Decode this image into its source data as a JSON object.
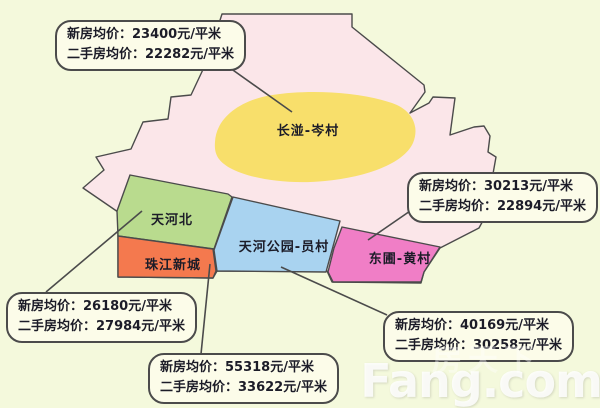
{
  "theme": {
    "bg": "#F4F9DC",
    "map_base": "#FBE6E9",
    "outline": "#4B4B4B",
    "bubble_fill": "#FCFCE9",
    "bubble_border": "#4B4B4B",
    "text_dark": "#1C1C28"
  },
  "map": {
    "outline_color": "#4B4B4B",
    "base_color": "#FBE6E9",
    "regions": [
      {
        "id": "changban-cencun",
        "label": "长湴-岑村",
        "color": "#F8DF6B"
      },
      {
        "id": "tianhebei",
        "label": "天河北",
        "color": "#B9DB8E"
      },
      {
        "id": "zhujiang-xincheng",
        "label": "珠江新城",
        "color": "#F4794E"
      },
      {
        "id": "tianhe-park-yuancun",
        "label": "天河公园-员村",
        "color": "#A9D3F0"
      },
      {
        "id": "dongpu-huangcun",
        "label": "东圃-黄村",
        "color": "#F07EC6"
      }
    ]
  },
  "callouts": [
    {
      "target": "changban-cencun",
      "new_price": 23400,
      "resale_price": 22282,
      "line1": "新房均价：23400元/平米",
      "line2": "二手房均价：22282元/平米"
    },
    {
      "target": "dongpu-huangcun",
      "new_price": 30213,
      "resale_price": 22894,
      "line1": "新房均价：30213元/平米",
      "line2": "二手房均价：22894元/平米"
    },
    {
      "target": "tianhebei",
      "new_price": 26180,
      "resale_price": 27984,
      "line1": "新房均价：26180元/平米",
      "line2": "二手房均价：27984元/平米"
    },
    {
      "target": "zhujiang-xincheng",
      "new_price": 55318,
      "resale_price": 33622,
      "line1": "新房均价：55318元/平米",
      "line2": "二手房均价：33622元/平米"
    },
    {
      "target": "tianhe-park-yuancun",
      "new_price": 40169,
      "resale_price": 30258,
      "line1": "新房均价：40169元/平米",
      "line2": "二手房均价：30258元/平米"
    }
  ],
  "watermark": {
    "brand": "Fang.com",
    "brand_cn": "房天下"
  }
}
